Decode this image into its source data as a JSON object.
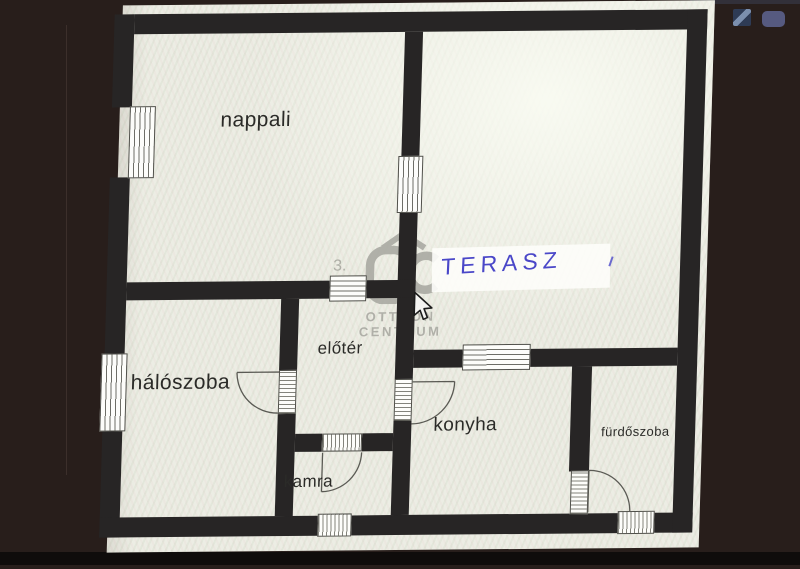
{
  "plan": {
    "rooms": [
      {
        "name": "nappali"
      },
      {
        "name": "hálószoba"
      },
      {
        "name": "előtér"
      },
      {
        "name": "konyha"
      },
      {
        "name": "kamra"
      },
      {
        "name": "fürdőszoba"
      }
    ],
    "handwritten_annotation": "TERASZ",
    "faint_room_number": "3.",
    "watermark": {
      "line1": "OTTHON",
      "line2": "CENTRUM"
    }
  },
  "icons": [
    {
      "name": "desktop-icon-slash"
    },
    {
      "name": "desktop-icon-rounded"
    },
    {
      "name": "mouse-cursor-icon"
    }
  ],
  "colors": {
    "background": "#281e1b",
    "paper": "#ecede4",
    "wall": "#272525",
    "ink_blue": "#4a47c8",
    "watermark_gray": "#a6a69f"
  }
}
